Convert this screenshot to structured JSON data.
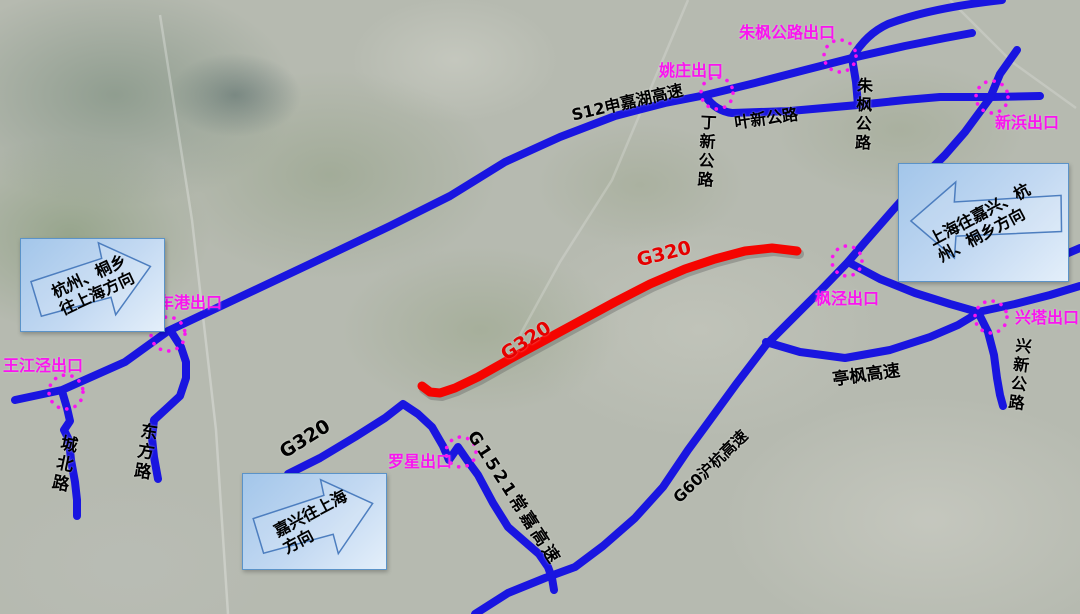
{
  "map": {
    "roads": {
      "s12_label": "S12申嘉湖高速",
      "dingxin_label": "丁新公路",
      "yexin_label": "叶新公路",
      "zhufeng_label": "朱枫公路",
      "chengbei_label": "城北路",
      "dongfang_label": "东方路",
      "g320_blue_label": "G320",
      "g1521_label": "G1521常嘉高速",
      "g60_label": "G60沪杭高速",
      "tingfeng_label": "亭枫高速",
      "xingxin_label": "兴新公路",
      "g320_red_label_upper": "G320",
      "g320_red_label_lower": "G320"
    },
    "exits": {
      "zhufeng_gonglu": "朱枫公路出口",
      "yaozhuang": "姚庄出口",
      "xinbang": "新浜出口",
      "chegang": "车港出口",
      "wangjiangjing": "王江泾出口",
      "luoxing": "罗星出口",
      "fengjing": "枫泾出口",
      "xingta": "兴塔出口"
    },
    "callouts": {
      "left": {
        "line1": "杭州、桐乡",
        "line2": "往上海方向"
      },
      "right": {
        "line1": "上海往嘉兴、杭",
        "line2": "州、桐乡方向"
      },
      "bottom": {
        "line1": "嘉兴往上海",
        "line2": "方向"
      }
    },
    "colors": {
      "expressway_blue": "#1915E0",
      "g320_red": "#F50400",
      "exit_marker_magenta": "#FA14F0",
      "callout_fill": "#BCD6F2",
      "callout_border": "#5B93C8"
    }
  }
}
